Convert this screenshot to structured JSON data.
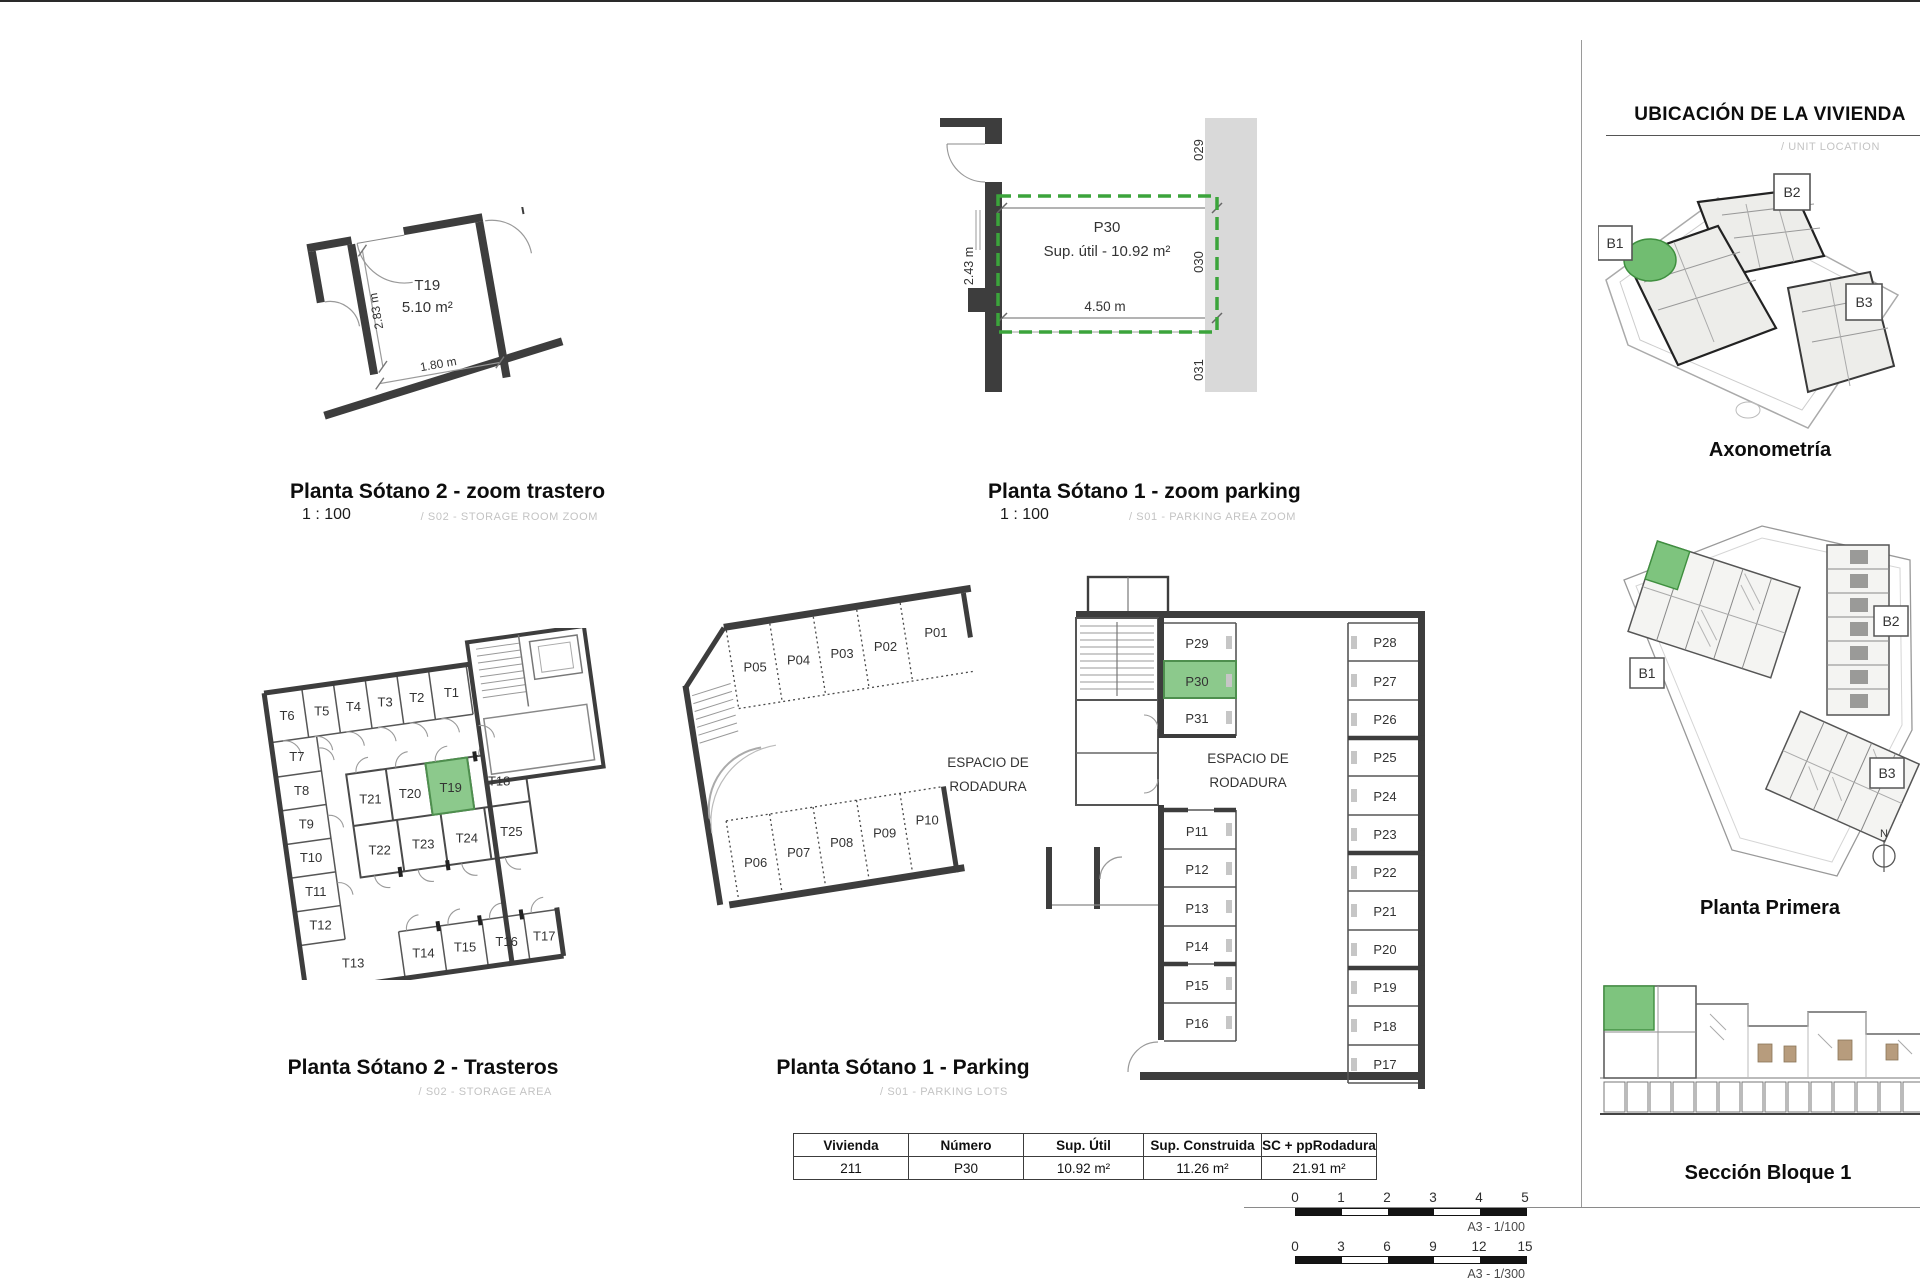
{
  "colors": {
    "highlight_green": "#8cc98c",
    "highlight_border": "#4e8f4e",
    "dash_green": "#3ba43b",
    "wall": "#3d3d3d",
    "band_gray": "#d9d9d9"
  },
  "storage_zoom": {
    "title": "Planta Sótano 2 - zoom trastero",
    "scale": "1 : 100",
    "subtitle": "/ S02 - STORAGE ROOM ZOOM",
    "unit": "T19",
    "area": "5.10 m²",
    "dim_w": "1.80 m",
    "dim_h": "2.83 m"
  },
  "parking_zoom": {
    "title": "Planta Sótano 1 - zoom parking",
    "scale": "1 : 100",
    "subtitle": "/ S01 - PARKING AREA ZOOM",
    "unit": "P30",
    "area_label": "Sup. útil - 10.92 m²",
    "dim_w": "4.50 m",
    "dim_h": "2.43 m",
    "band": [
      "029",
      "030",
      "031"
    ]
  },
  "storage_plan": {
    "title": "Planta Sótano 2 - Trasteros",
    "subtitle": "/ S02 - STORAGE AREA",
    "top_row": [
      "T6",
      "T5",
      "T4",
      "T3",
      "T2",
      "T1"
    ],
    "left_col": [
      "T7",
      "T8",
      "T9",
      "T10",
      "T11",
      "T12"
    ],
    "t13": "T13",
    "island_top": [
      "T21",
      "T20",
      "T19",
      "T18"
    ],
    "island_bottom": [
      "T22",
      "T23",
      "T24",
      "T25"
    ],
    "bottom_row": [
      "T14",
      "T15",
      "T16",
      "T17"
    ],
    "highlight": "T19"
  },
  "parking_plan": {
    "title": "Planta Sótano 1 - Parking",
    "subtitle": "/ S01 - PARKING LOTS",
    "roadway": [
      "ESPACIO DE",
      "RODADURA"
    ],
    "top_bays": [
      "P05",
      "P04",
      "P03",
      "P02",
      "P01"
    ],
    "bottom_bays": [
      "P06",
      "P07",
      "P08",
      "P09",
      "P10"
    ],
    "mid_top": [
      "P29",
      "P30",
      "P31"
    ],
    "mid_bottom": [
      "P11",
      "P12",
      "P13",
      "P14",
      "P15",
      "P16"
    ],
    "right_col": [
      "P28",
      "P27",
      "P26",
      "P25",
      "P24",
      "P23",
      "P22",
      "P21",
      "P20",
      "P19",
      "P18",
      "P17"
    ],
    "highlight": "P30"
  },
  "summary_table": {
    "headers": [
      "Vivienda",
      "Número",
      "Sup. Útil",
      "Sup. Construida",
      "SC + ppRodadura"
    ],
    "row": [
      "211",
      "P30",
      "10.92 m²",
      "11.26 m²",
      "21.91 m²"
    ]
  },
  "sidebar": {
    "header": "UBICACIÓN DE LA VIVIENDA",
    "header_sub": "/ UNIT LOCATION",
    "axon_caption": "Axonometría",
    "plan_caption": "Planta Primera",
    "section_caption": "Sección Bloque 1",
    "blocks": [
      "B1",
      "B2",
      "B3"
    ],
    "north": "N"
  },
  "scalebars": [
    {
      "ticks": [
        "0",
        "1",
        "2",
        "3",
        "4",
        "5"
      ],
      "note": "A3 - 1/100"
    },
    {
      "ticks": [
        "0",
        "3",
        "6",
        "9",
        "12",
        "15"
      ],
      "note": "A3 - 1/300"
    }
  ]
}
